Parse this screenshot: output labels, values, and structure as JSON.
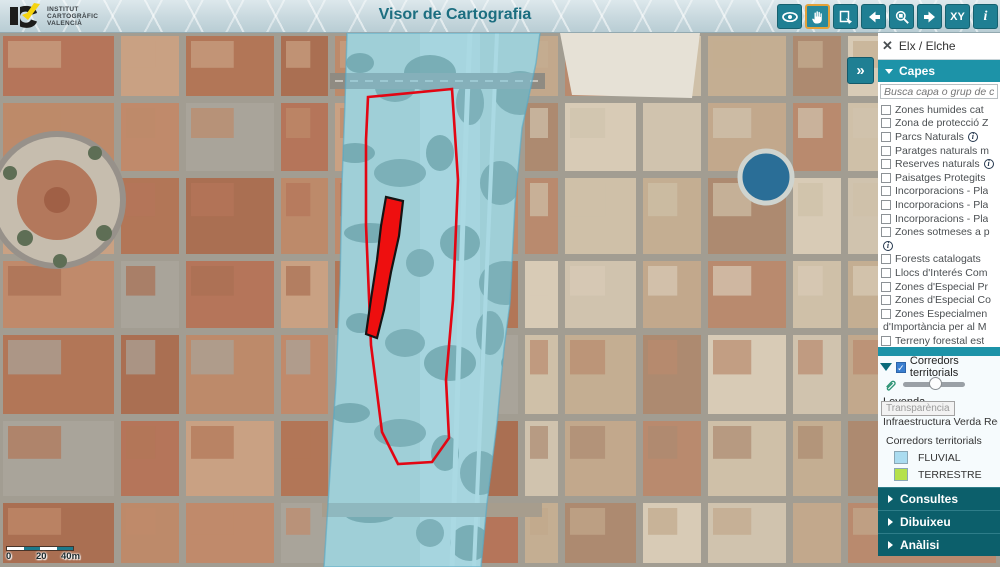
{
  "header": {
    "org_lines": [
      "INSTITUT",
      "CARTOGRÀFIC",
      "VALENCIÀ"
    ],
    "title": "Visor de Cartografia",
    "toolbar": [
      {
        "id": "eye-tool",
        "icon": "eye",
        "active": false
      },
      {
        "id": "pan-tool",
        "icon": "hand",
        "active": true
      },
      {
        "id": "extent-tool",
        "icon": "extent",
        "active": false
      },
      {
        "id": "history-back",
        "icon": "arrow-left",
        "active": false
      },
      {
        "id": "zoom-window-tool",
        "icon": "zoom-window",
        "active": false
      },
      {
        "id": "history-forward",
        "icon": "arrow-right",
        "active": false
      },
      {
        "id": "xy-tool",
        "text": "XY",
        "active": false
      },
      {
        "id": "info-tool",
        "text": "i",
        "active": false
      }
    ]
  },
  "panel": {
    "collapse_glyph": "»",
    "location": {
      "close_icon": "✕",
      "label": "Elx / Elche"
    },
    "capes_header": "Capes",
    "search_placeholder": "Busca capa o grup de capes",
    "layers": [
      {
        "label": "Zones humides cat",
        "checked": false
      },
      {
        "label": "Zona de protecció Z",
        "checked": false
      },
      {
        "label": "Parcs Naturals",
        "checked": false,
        "info": true
      },
      {
        "label": "Paratges naturals m",
        "checked": false
      },
      {
        "label": "Reserves naturals",
        "checked": false,
        "info": true
      },
      {
        "label": "Paisatges Protegits",
        "checked": false
      },
      {
        "label": "Incorporacions - Pla",
        "checked": false
      },
      {
        "label": "Incorporacions - Pla",
        "checked": false
      },
      {
        "label": "Incorporacions - Pla",
        "checked": false
      },
      {
        "label": "Zones sotmeses a p",
        "checked": false,
        "info_wrap": true
      },
      {
        "label": "Forests catalogats",
        "checked": false
      },
      {
        "label": "Llocs d'Interés Com",
        "checked": false
      },
      {
        "label": "Zones d'Especial Pr",
        "checked": false
      },
      {
        "label": "Zones d'Especial Co",
        "checked": false
      },
      {
        "label": "Zones Especialmen",
        "checked": false,
        "wrap": "d'Importància per al M"
      },
      {
        "label": "Terreny forestal est",
        "checked": false
      },
      {
        "label": "Corredors territorial",
        "checked": true
      }
    ],
    "active_layer": {
      "label": "Corredors territorials",
      "checked": true,
      "legend_title": "Leyenda",
      "tooltip": "Transparència",
      "sublabel": "Infraestructura Verda Regio",
      "group": "Corredors territorials",
      "entries": [
        {
          "label": "FLUVIAL",
          "color": "#aadcf0"
        },
        {
          "label": "TERRESTRE",
          "color": "#b5e14c"
        }
      ]
    },
    "sections": [
      {
        "label": "Consultes"
      },
      {
        "label": "Dibuixeu"
      },
      {
        "label": "Anàlisi"
      }
    ]
  },
  "map": {
    "scale": {
      "labels": [
        "0",
        "20",
        "40m"
      ]
    },
    "overlay_colors": {
      "fluvial_corridor": "#7ecbe3",
      "selection_outline": "#e30613",
      "selection_fill": "#ee0f0f"
    }
  },
  "colors": {
    "accent_teal": "#1d93a8",
    "dark_teal": "#0c5f6b",
    "toolbar_btn": "#1f7f93",
    "active_tool_border": "#e3a23a",
    "title_text": "#1c6e80"
  }
}
